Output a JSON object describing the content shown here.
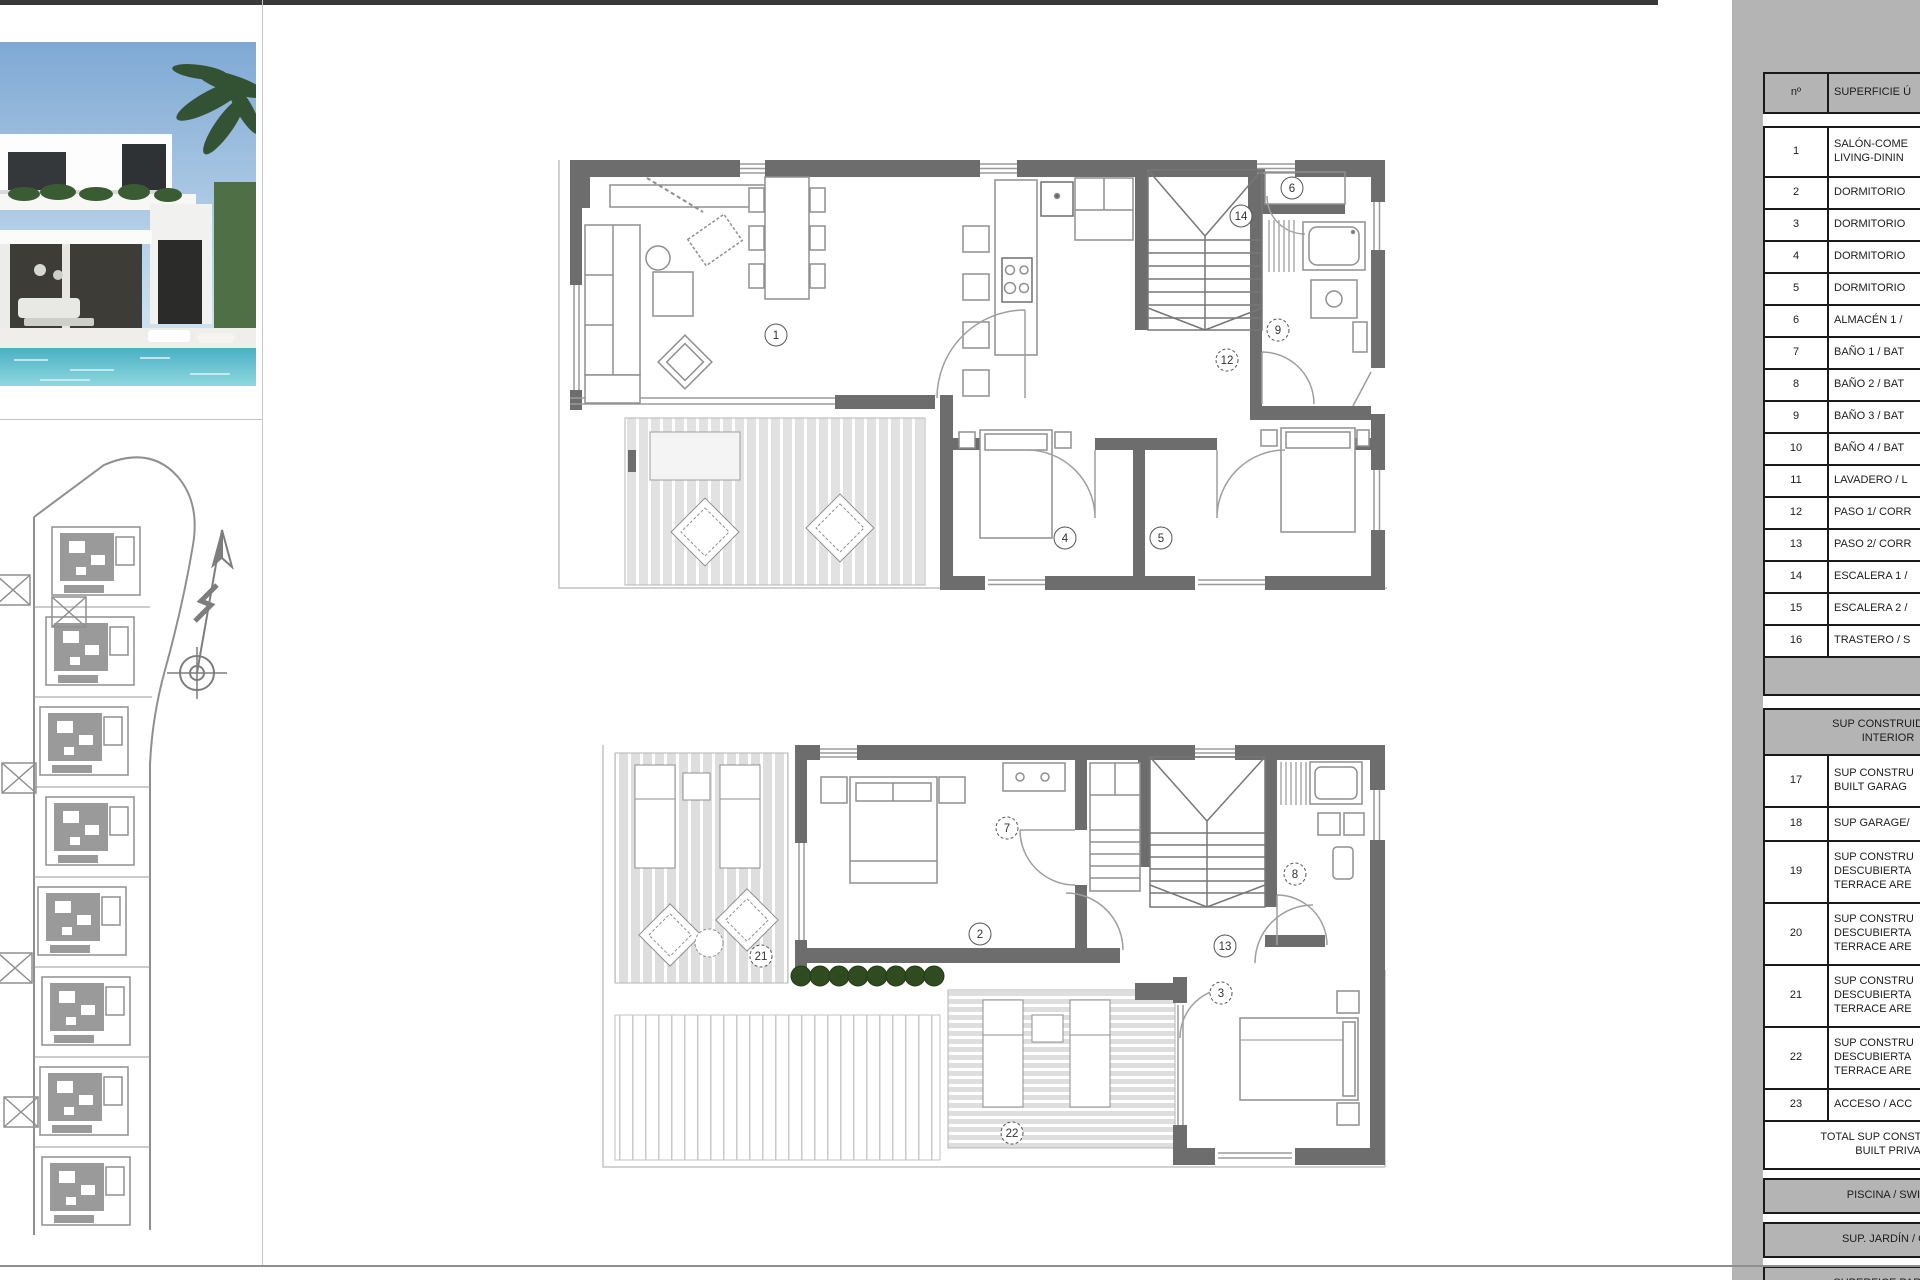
{
  "panel": {
    "header": {
      "num": "nº",
      "desc": "SUPERFICIE Ú"
    },
    "rows": [
      {
        "num": "1",
        "label": "SALÓN-COME\nLIVING-DININ"
      },
      {
        "num": "2",
        "label": "DORMITORIO"
      },
      {
        "num": "3",
        "label": "DORMITORIO"
      },
      {
        "num": "4",
        "label": "DORMITORIO"
      },
      {
        "num": "5",
        "label": "DORMITORIO"
      },
      {
        "num": "6",
        "label": "ALMACÉN 1 /"
      },
      {
        "num": "7",
        "label": "BAÑO 1 / BAT"
      },
      {
        "num": "8",
        "label": "BAÑO 2 / BAT"
      },
      {
        "num": "9",
        "label": "BAÑO 3 / BAT"
      },
      {
        "num": "10",
        "label": "BAÑO 4 / BAT"
      },
      {
        "num": "11",
        "label": "LAVADERO / L"
      },
      {
        "num": "12",
        "label": "PASO 1/ CORR"
      },
      {
        "num": "13",
        "label": "PASO 2/ CORR"
      },
      {
        "num": "14",
        "label": "ESCALERA 1 /"
      },
      {
        "num": "15",
        "label": "ESCALERA 2 /"
      },
      {
        "num": "16",
        "label": "TRASTERO / S"
      },
      {
        "num": "17",
        "label": "SUP CONSTRU\nBUILT GARAG"
      },
      {
        "num": "18",
        "label": "SUP GARAGE/"
      },
      {
        "num": "19",
        "label": "SUP CONSTRU\nDESCUBIERTA\nTERRACE ARE"
      },
      {
        "num": "20",
        "label": "SUP CONSTRU\nDESCUBIERTA\nTERRACE ARE"
      },
      {
        "num": "21",
        "label": "SUP CONSTRU\nDESCUBIERTA\nTERRACE ARE"
      },
      {
        "num": "22",
        "label": "SUP CONSTRU\nDESCUBIERTA\nTERRACE ARE"
      },
      {
        "num": "23",
        "label": "ACCESO / ACC"
      }
    ],
    "section2_header": "SUP CONSTRUIDA IN\nINTERIOR",
    "total": "TOTAL SUP CONSTRUIDA\nBUILT PRIVA",
    "bars": [
      "PISCINA / SWIM",
      "SUP. JARDÍN / GA",
      "SUPERFICE PARCEL"
    ]
  },
  "plans": {
    "upper": {
      "labels": [
        {
          "n": "1"
        },
        {
          "n": "4"
        },
        {
          "n": "5"
        },
        {
          "n": "6"
        },
        {
          "n": "9"
        },
        {
          "n": "12"
        },
        {
          "n": "14"
        }
      ]
    },
    "lower": {
      "labels": [
        {
          "n": "2"
        },
        {
          "n": "3"
        },
        {
          "n": "7"
        },
        {
          "n": "8"
        },
        {
          "n": "13"
        },
        {
          "n": "21"
        },
        {
          "n": "22"
        }
      ]
    }
  },
  "colors": {
    "panel_bg": "#b4b4b4",
    "wall_gray": "#6d6d6d",
    "bush_green": "#2f4b1f",
    "pool_teal": "#49b0c4"
  }
}
